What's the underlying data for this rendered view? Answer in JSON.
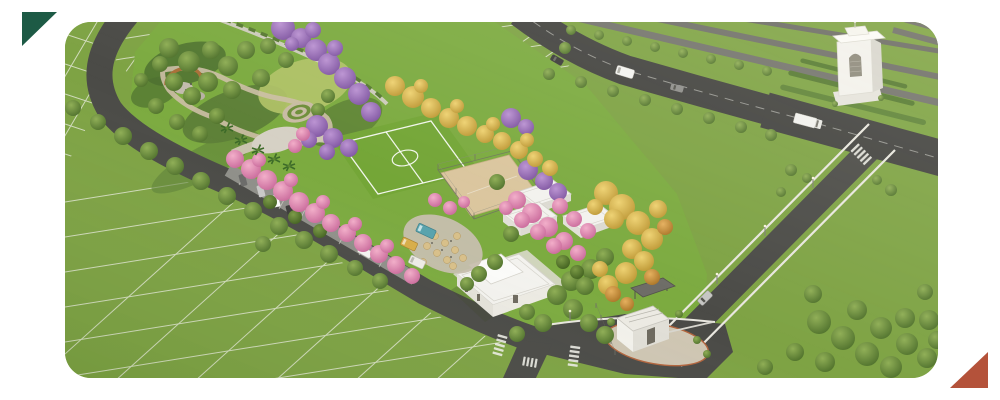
{
  "page": {
    "background_color": "#ffffff"
  },
  "decorations": {
    "top_left_triangle": {
      "color": "#1d5a45",
      "shape": "right-triangle"
    },
    "bottom_right_triangle": {
      "color": "#b4523a",
      "shape": "right-triangle"
    }
  },
  "hero_image": {
    "type": "aerial-3d-render",
    "corner_radius_px": 26,
    "description": "Aerial 3D rendering of a master-planned residential land development: a linear central park lined with purple, pink and yellow flowering trees, ornamental gardens with circular paths, a soccer field, a sand sports court, a food-truck plaza with umbrellas, white flat-roofed amenity pavilions and clubhouse, angled parking with cars, a gated entrance with guardhouse and barrier, pedestrian crosswalks, a tree-lined avenue with passing vehicles, a white entrance monument tower, and surveyed lots marked by thin white lines on green grass.",
    "features": [
      "surveyed lots marked with white lines",
      "linear central park",
      "ornamental garden with circular paths and ring planter",
      "soccer field with white markings",
      "sand sports court with fence",
      "food truck plaza with umbrellas",
      "white amenity pavilions",
      "clubhouse building",
      "angled parking bays with parked cars",
      "flowering trees in purple, pink and yellow",
      "entrance guardhouse with barrier gate and shelter",
      "pedestrian zebra crosswalks",
      "tree-lined avenue with traffic",
      "white entrance monument tower",
      "street lamps and perimeter fence"
    ],
    "vehicles": {
      "on_avenue": [
        "dark car",
        "white van",
        "gray car",
        "white truck"
      ],
      "parked_cars": [
        "gray car",
        "silver car",
        "white car",
        "dark car",
        "white van"
      ],
      "food_trucks": [
        "teal food truck",
        "yellow food truck",
        "white food truck"
      ],
      "at_entrance": [
        "silver car"
      ]
    },
    "palette": {
      "grass_base": "#7ea344",
      "park_lawn": "#7cab40",
      "road": "#4b4b47",
      "avenue": "#434340",
      "sidewalk": "#e9e7df",
      "lot_line": "#f2f2ea",
      "sand_court": "#dbc69e",
      "plaza": "#c7bfae",
      "building_white": "#f3f2ee",
      "building_shadow": "#dddbd3",
      "tree_green": "#5d8036",
      "tree_purple": "#9a6cb4",
      "tree_pink": "#e18cb2",
      "tree_yellow": "#d9b54a",
      "page_bg": "#ffffff"
    }
  }
}
